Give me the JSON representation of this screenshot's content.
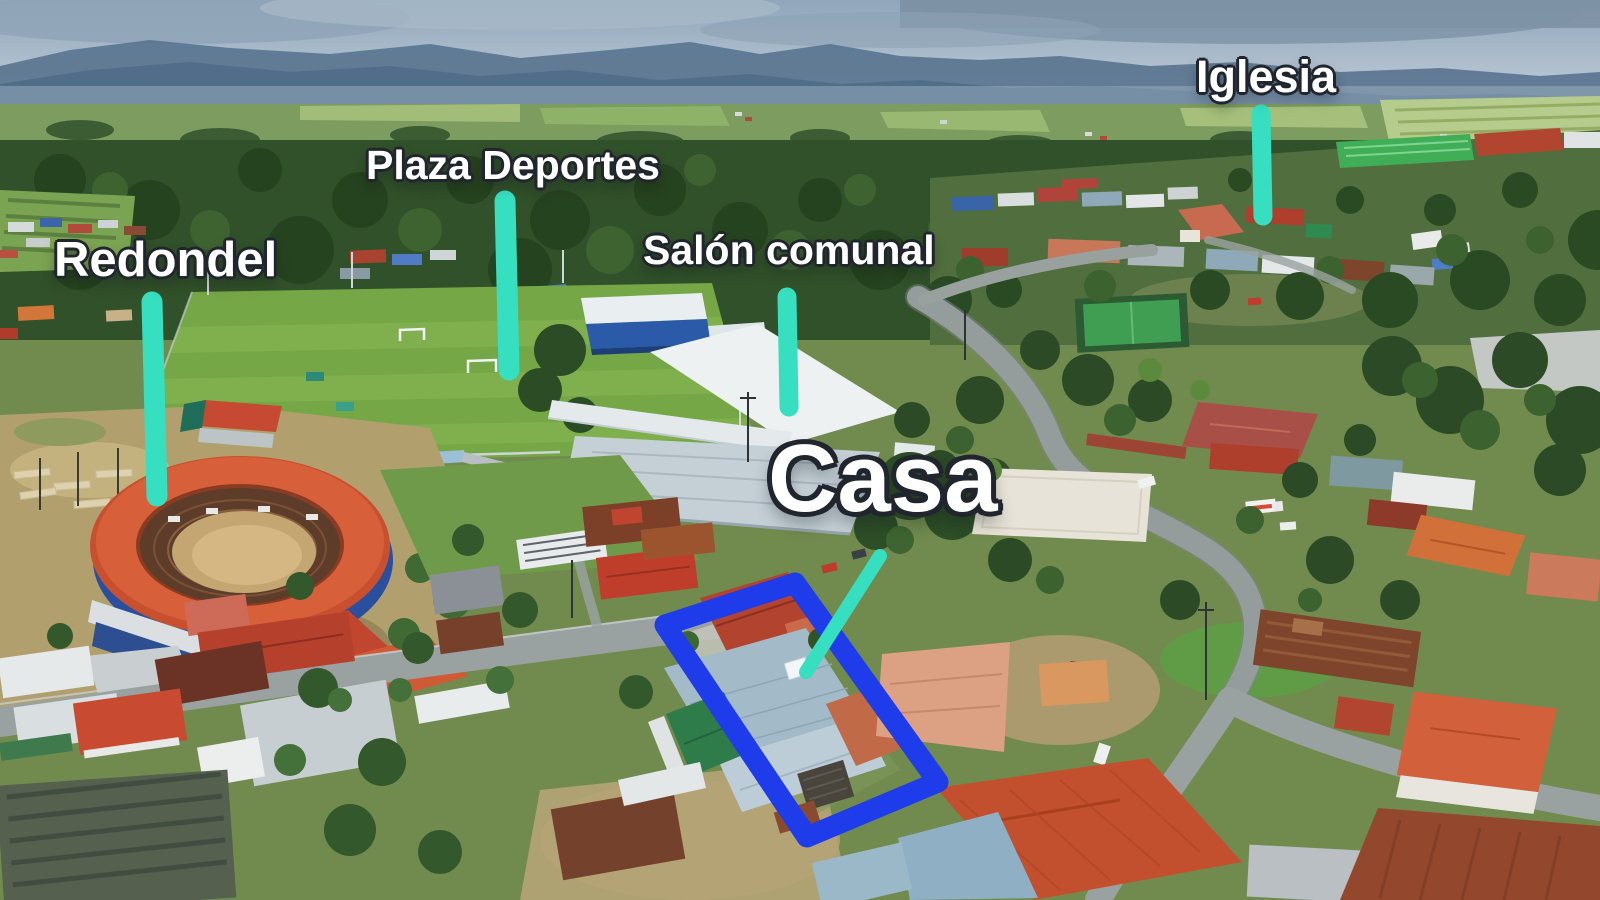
{
  "labels": {
    "redondel": "Redondel",
    "plaza_deportes": "Plaza Deportes",
    "salon_comunal": "Salón comunal",
    "iglesia": "Iglesia",
    "casa": "Casa"
  },
  "annotations": {
    "marker_line_color": "#35dfc0",
    "property_outline_color": "#1e3ce9",
    "label_text_color": "#ffffff",
    "label_outline_color": "#20252e"
  }
}
